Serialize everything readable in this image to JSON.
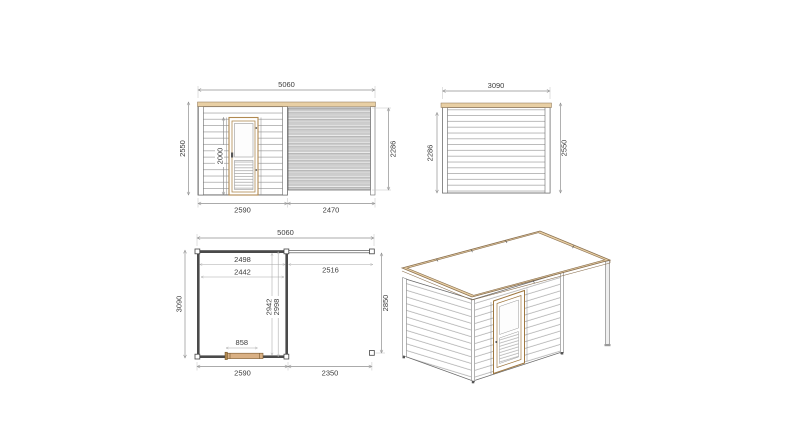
{
  "drawing_title": "cabin-with-canopy-technical-drawing",
  "colors": {
    "wood_fascia": "#e8cfa4",
    "wood_outline": "#8a7050",
    "door_wood": "#d9b084",
    "wall_line": "#5a5a5a",
    "shade_fill": "#cccccc",
    "dim_line": "#8f8f8f",
    "text": "#3c3c3c"
  },
  "views": {
    "front_elevation": {
      "dims": {
        "width_total": "5060",
        "height_front": "2550",
        "door_height": "2000",
        "height_back": "2286",
        "width_room": "2590",
        "width_canopy": "2470"
      }
    },
    "side_elevation": {
      "dims": {
        "width": "3090",
        "height_back": "2286",
        "height_front": "2550"
      }
    },
    "floor_plan": {
      "dims": {
        "width_total": "5060",
        "inner_width_a": "2498",
        "inner_width_b": "2442",
        "canopy_width": "2516",
        "depth": "3090",
        "inner_depth_a": "2942",
        "inner_depth_b": "2998",
        "canopy_depth": "2850",
        "door_width": "858",
        "width_room": "2590",
        "width_canopy": "2350"
      }
    }
  }
}
